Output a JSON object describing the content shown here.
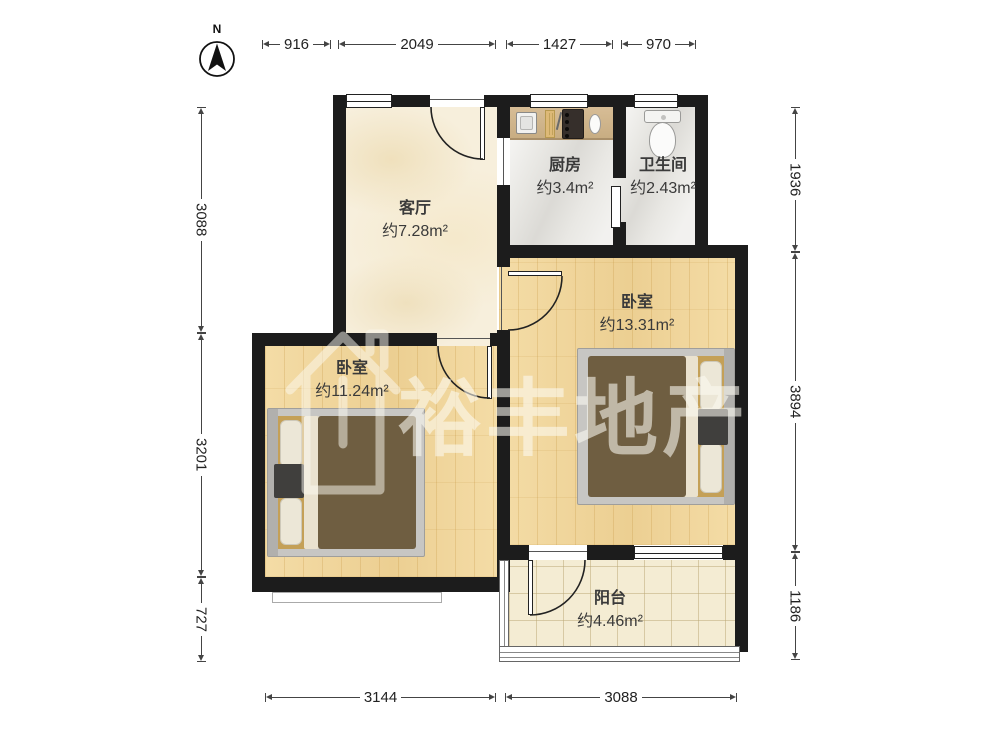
{
  "compass": {
    "label": "N"
  },
  "watermark": {
    "text": "裕丰地产"
  },
  "rooms": {
    "living": {
      "name": "客厅",
      "area": "约7.28m²"
    },
    "kitchen": {
      "name": "厨房",
      "area": "约3.4m²"
    },
    "bath": {
      "name": "卫生间",
      "area": "约2.43m²"
    },
    "bedroom_right": {
      "name": "卧室",
      "area": "约13.31m²"
    },
    "bedroom_left": {
      "name": "卧室",
      "area": "约11.24m²"
    },
    "balcony": {
      "name": "阳台",
      "area": "约4.46m²"
    }
  },
  "dimensions": {
    "top": [
      "916",
      "2049",
      "1427",
      "970"
    ],
    "left": [
      "3088",
      "3201",
      "727"
    ],
    "right": [
      "1936",
      "3894",
      "1186"
    ],
    "bottom": [
      "3144",
      "3088"
    ]
  },
  "colors": {
    "wall": "#1c1c1c",
    "wood-floor": "#f2d9a2",
    "marble-cream": "#f7efdc",
    "tile-gray": "#e9e8e4",
    "balcony-tile": "#f4ecd3",
    "counter": "#cfb48b",
    "duvet": "#6f5e41",
    "mattress": "#c4a057",
    "dim-line": "#444444",
    "label-text": "#3a3a3a"
  }
}
